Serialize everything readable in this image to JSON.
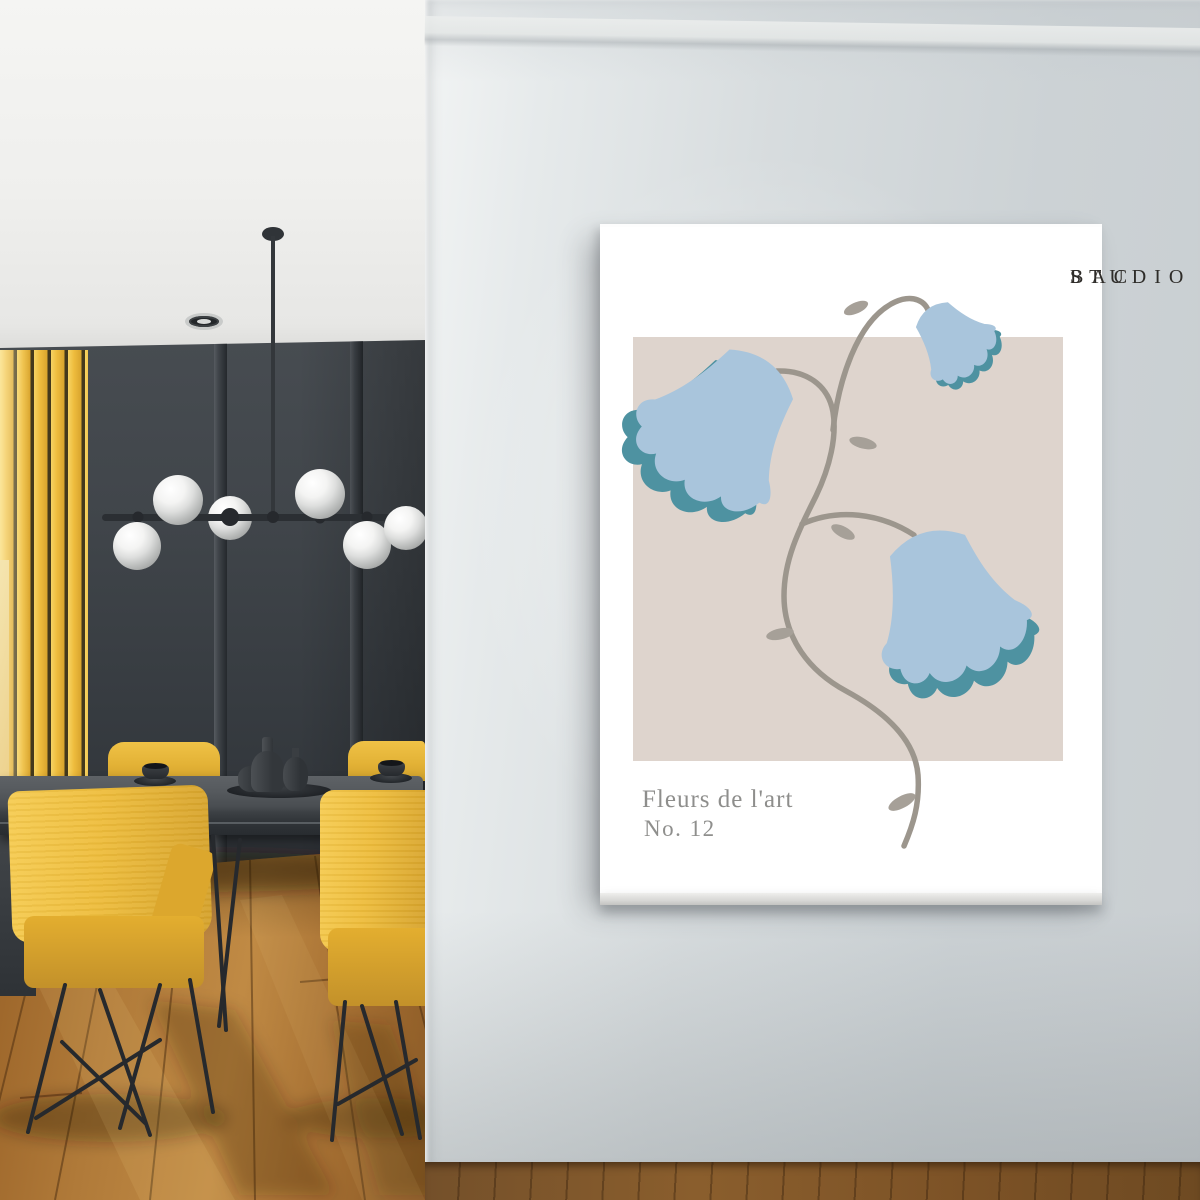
{
  "poster": {
    "brand_line1": "STUDIO",
    "brand_line2": "BAC",
    "title": "Fleurs de l'art",
    "edition": "No. 12",
    "artwork_subject": "three blue bellflowers on a curving grey vine with leaves",
    "colors": {
      "canvas_white": "#ffffff",
      "panel_beige": "#ded4cd",
      "flower_blue": "#a9c5dc",
      "flower_teal": "#4e92a1",
      "stem_grey": "#9c968d",
      "leaf_grey": "#a6a098",
      "brand_text": "#2e2c29",
      "caption_text": "#8e8e8c"
    }
  },
  "interior": {
    "colors": {
      "ceiling": "#f2f2f0",
      "dark_wall": "#3d4247",
      "accent_yellow": "#e8b93a",
      "floor_wood": "#b5803d",
      "right_wall_grey": "#d3d9db",
      "chandelier_metal": "#2b2f33",
      "globe_white": "#f4f4f3",
      "table_grey": "#4a4e52"
    },
    "objects": [
      "globe-chandelier",
      "recessed-spotlight",
      "yellow-slat-panel",
      "dining-table",
      "ceramic-vases",
      "espresso-cups",
      "yellow-chairs",
      "wood-floor",
      "canvas-print"
    ]
  }
}
